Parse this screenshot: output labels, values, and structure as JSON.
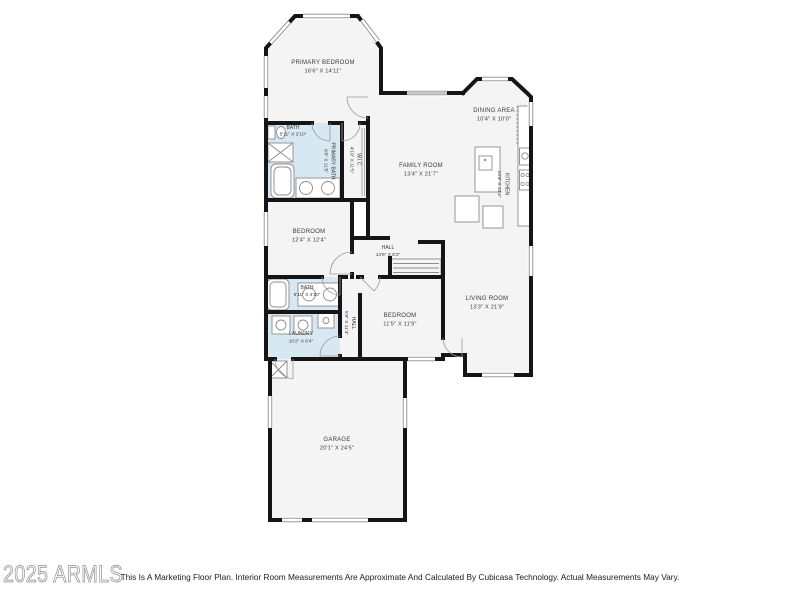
{
  "watermark": "2025 ARMLS",
  "disclaimer": "This Is A Marketing Floor Plan. Interior Room Measurements Are Approximate And Calculated By Cubicasa Technology. Actual Measurements May Vary.",
  "rooms": {
    "primary_bedroom": {
      "name": "PRIMARY BEDROOM",
      "dims": "16'6\" X 14'11\""
    },
    "bath_top": {
      "name": "BATH",
      "dims": "5'11\" X 2'10\""
    },
    "primary_bath": {
      "name": "PRIMARY BATH",
      "dims": "9'8\" X 11'5\""
    },
    "wic": {
      "name": "W.I.C.",
      "dims": "4'10\" X 11'5\""
    },
    "family_room": {
      "name": "FAMILY ROOM",
      "dims": "13'4\" X 21'7\""
    },
    "dining_area": {
      "name": "DINING AREA",
      "dims": "10'4\" X 10'0\""
    },
    "kitchen": {
      "name": "KITCHEN",
      "dims": "10'4\" X 13'4\""
    },
    "bedroom_mid": {
      "name": "BEDROOM",
      "dims": "12'4\" X 12'4\""
    },
    "hall": {
      "name": "HALL",
      "dims": "14'6\" X 6'2\""
    },
    "bath_mid": {
      "name": "BATH",
      "dims": "9'11\" X 4'10\""
    },
    "hall_small": {
      "name": "HALL",
      "dims": "5'9\" X 11'4\""
    },
    "laundry": {
      "name": "LAUNDRY",
      "dims": "10'2\" X 6'4\""
    },
    "bedroom_bottom": {
      "name": "BEDROOM",
      "dims": "11'5\" X 11'9\""
    },
    "living_room": {
      "name": "LIVING ROOM",
      "dims": "13'3\" X 21'9\""
    },
    "garage": {
      "name": "GARAGE",
      "dims": "20'1\" X 24'5\""
    }
  },
  "colors": {
    "wall": "#151515",
    "room_fill": "#f4f4f4",
    "bath_fill": "#d7e8f2",
    "text": "#3a3a3a"
  }
}
